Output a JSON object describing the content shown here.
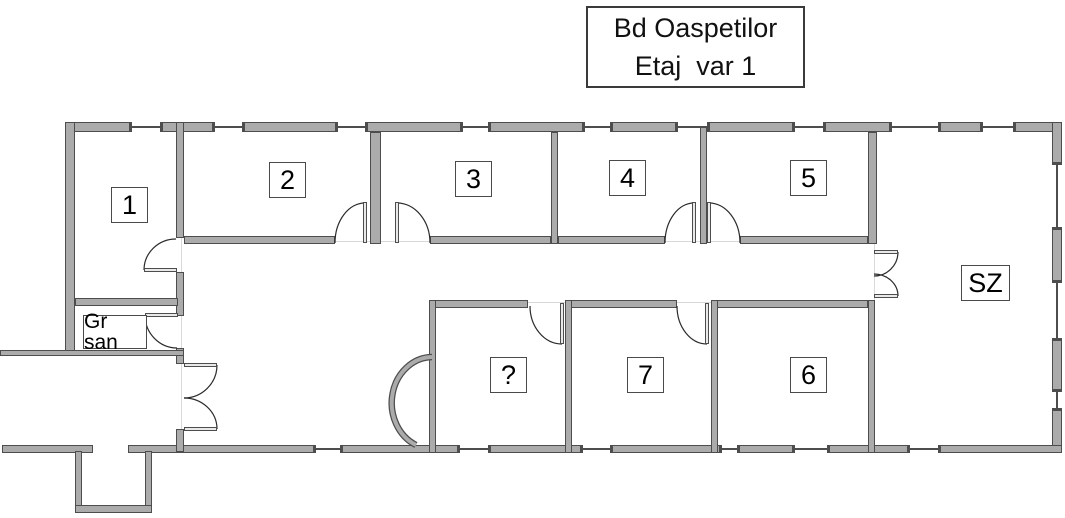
{
  "title": {
    "line1": "Bd Oaspetilor",
    "line2": "Etaj  var 1"
  },
  "rooms": {
    "r1": {
      "label": "1"
    },
    "r2": {
      "label": "2"
    },
    "r3": {
      "label": "3"
    },
    "r4": {
      "label": "4"
    },
    "r5": {
      "label": "5"
    },
    "r6": {
      "label": "6"
    },
    "r7": {
      "label": "7"
    },
    "unknown": {
      "label": "?"
    },
    "sz": {
      "label": "SZ"
    },
    "gr_san": {
      "label": "Gr san"
    }
  },
  "colors": {
    "wall_fill": "#ababab",
    "wall_outline": "#4d4d4d",
    "door_arc": "#2b2b2b",
    "window_line": "#4a4a4a",
    "threshold_line": "#d9d9d9",
    "background": "#ffffff",
    "label_border": "#4a4a4a",
    "text": "#000000"
  }
}
